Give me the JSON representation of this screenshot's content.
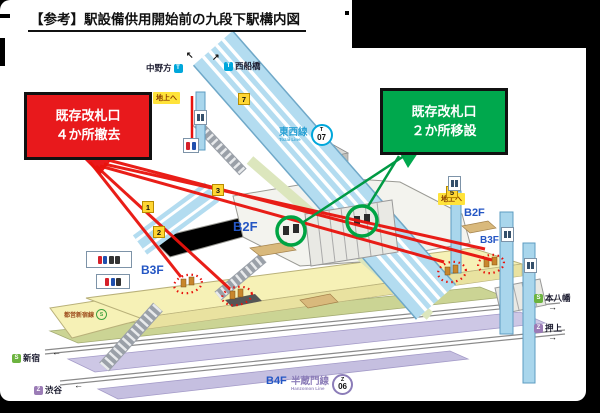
{
  "frame": {
    "title": "【参考】駅設備供用開始前の九段下駅構内図"
  },
  "callouts": {
    "removed": {
      "line1": "既存改札口",
      "line2": "４か所撤去",
      "color": "#e8191c"
    },
    "relocated": {
      "line1": "既存改札口",
      "line2": "２か所移設",
      "color": "#00a84d"
    }
  },
  "railway_lines": {
    "tozai": {
      "name": "東西線",
      "name_en": "Tozai Line",
      "code_letter": "T",
      "code_number": "07",
      "color": "#00a7db"
    },
    "hanzomon": {
      "name": "半蔵門線",
      "name_en": "Hanzomon Line",
      "code_letter": "Z",
      "code_number": "06",
      "color": "#8b7cb8"
    },
    "toei_shinjuku": {
      "name": "都営新宿線",
      "code_letter": "S",
      "color": "#3fa23f"
    }
  },
  "floors": {
    "b2f": "B2F",
    "b3f": "B3F",
    "b4f": "B4F"
  },
  "directions": {
    "nakano": {
      "label": "中野方",
      "line_letter": "T"
    },
    "nishi_funabashi": {
      "label": "西船橋",
      "line_letter": "T"
    },
    "motoyawata": {
      "label": "本八幡",
      "line_letter": "S"
    },
    "oshiage": {
      "label": "押上",
      "line_letter": "Z"
    },
    "shinjuku": {
      "label": "新宿",
      "line_letter": "S"
    },
    "shibuya": {
      "label": "渋谷",
      "line_letter": "Z"
    }
  },
  "signs": {
    "to_ground": "地上へ"
  },
  "exit_numbers": {
    "e1": "1",
    "e2": "2",
    "e3": "3",
    "e5": "5",
    "e7": "7"
  },
  "arrows": {
    "up_left": "↖",
    "up_right": "↗",
    "left": "←",
    "right": "→"
  }
}
